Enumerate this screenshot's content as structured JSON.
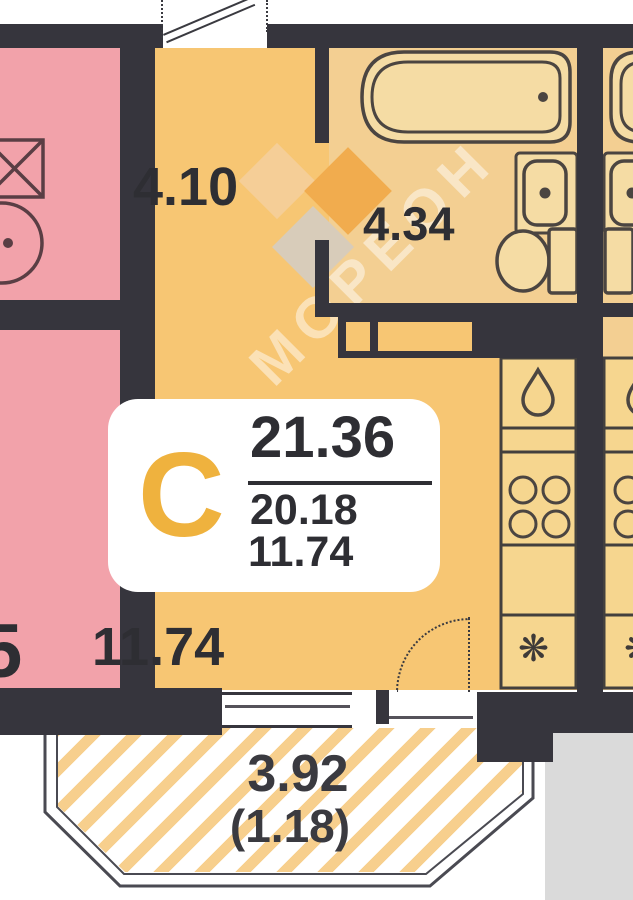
{
  "plan": {
    "badge": {
      "type_letter": "С",
      "total_area": "21.36",
      "living_area": "20.18",
      "room_area": "11.74"
    },
    "rooms": {
      "hallway_area": "4.10",
      "bathroom_area": "4.34",
      "living_room_area": "11.74",
      "balcony_area": "3.92",
      "balcony_area_reduced": "(1.18)",
      "adjacent_room_digit": "5"
    },
    "watermark_text": "МОРЕОН",
    "icons": {
      "fridge_snowflake": "❋",
      "kitchen_sink": "water-drop",
      "stove": "four-burners"
    },
    "colors": {
      "room_fill": "#F7C673",
      "wet_zone_fill": "#F3CF92",
      "kitchen_cell_fill": "#F6D68F",
      "adjacent_apartment_fill": "#F2A2AA",
      "wall": "#36353D",
      "balcony_hatch": "#F7CF8D",
      "badge_letter": "#EFB23E",
      "label_text": "#2E2E33"
    }
  }
}
